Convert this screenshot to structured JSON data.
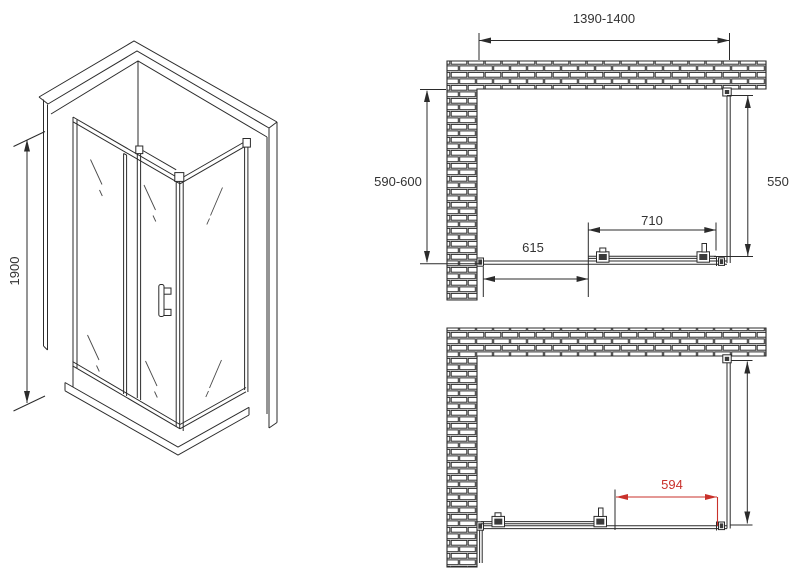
{
  "drawing": {
    "iso": {
      "height_label": "1900"
    },
    "plan_top": {
      "width_label": "1390-1400",
      "depth_label": "590-600",
      "side_label": "550",
      "door_label": "710",
      "fixed_label": "615"
    },
    "plan_bottom": {
      "opening_label": "594"
    },
    "colors": {
      "line": "#2b2b2b",
      "accent_red": "#c9312b"
    }
  }
}
